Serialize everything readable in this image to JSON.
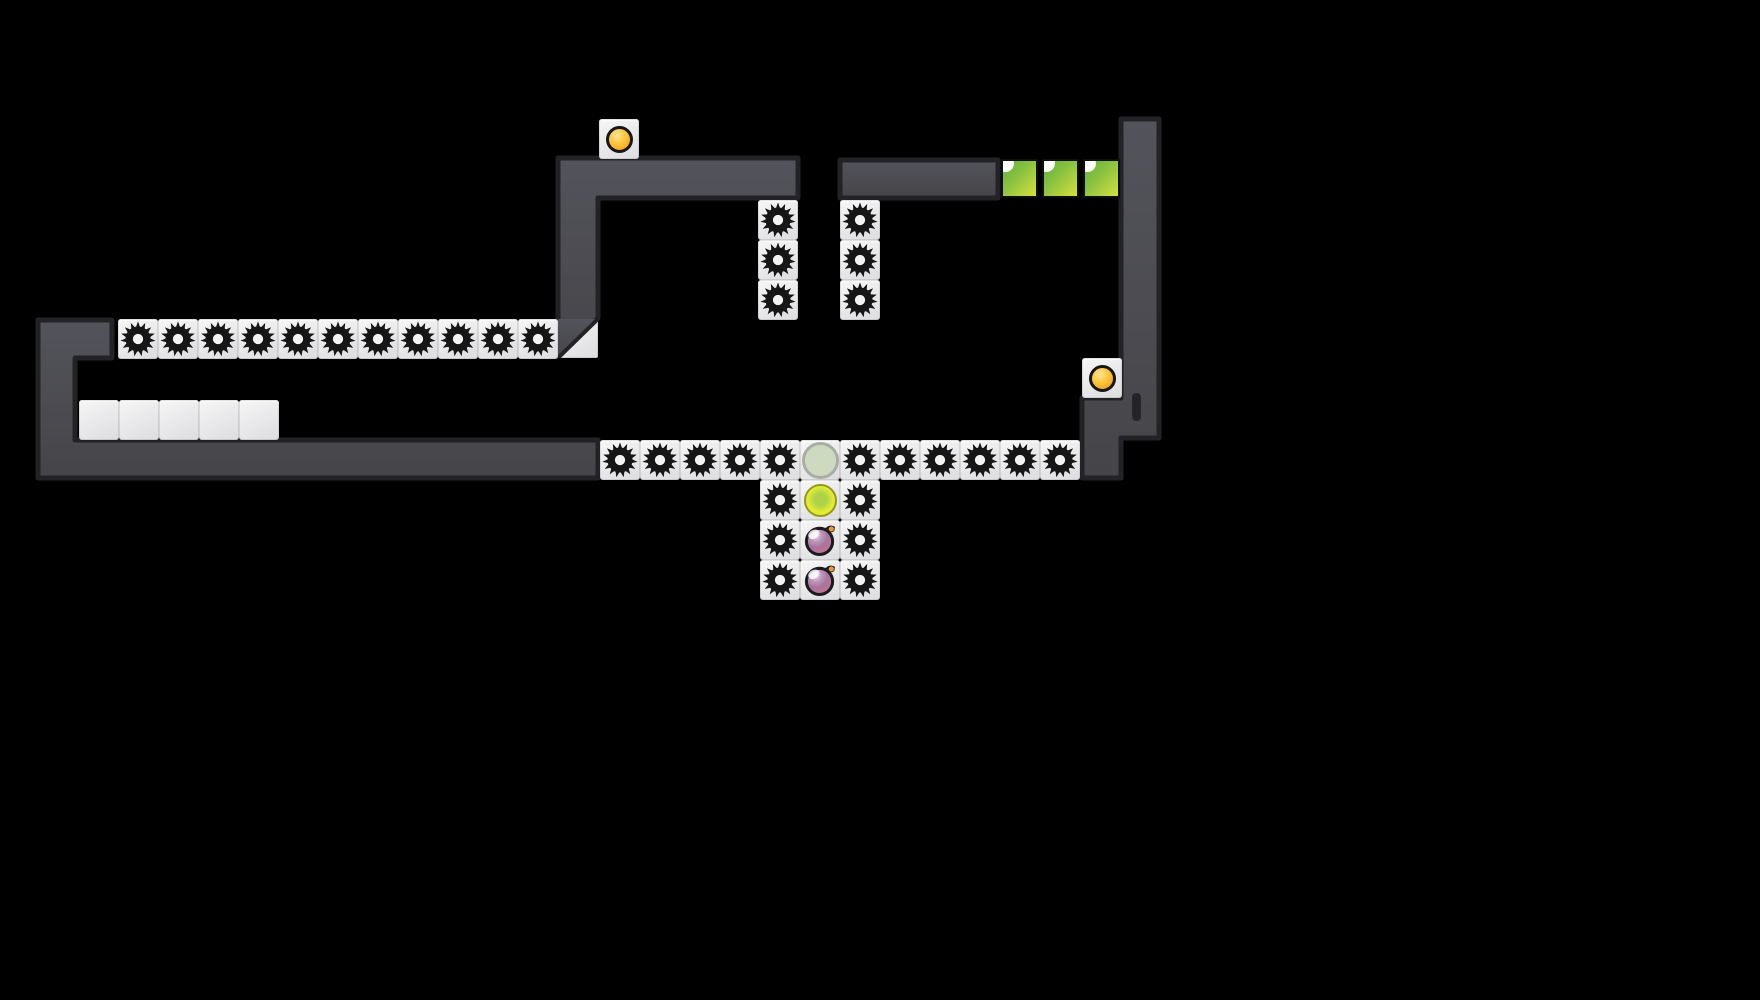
{
  "level": {
    "canvas": {
      "width": 1760,
      "height": 1000
    },
    "palette": {
      "bg": "#000000",
      "wall_fill_top": "#53535b",
      "wall_fill_bottom": "#454549",
      "wall_border": "#232327",
      "tile_fill": "#ececee",
      "saw": "#161616",
      "saw_hole": "#f3f3f3",
      "coin_gold": "#f5a91f",
      "ghost_fill": "#cedabf",
      "ghost_ring": "#a9aea4",
      "lemon_a": "#e9eb33",
      "lemon_b": "#abd44b",
      "lemon_ring": "#8f9a1f",
      "green_a": "#5eb23c",
      "green_b": "#d5e13c",
      "plum_ring": "#1b1b20",
      "plum_stem": "#f09a28"
    },
    "walls": [
      {
        "name": "left-structure-wall",
        "points": [
          [
            38,
            320
          ],
          [
            112,
            320
          ],
          [
            112,
            358
          ],
          [
            75,
            358
          ],
          [
            75,
            440
          ],
          [
            598,
            440
          ],
          [
            598,
            478
          ],
          [
            38,
            478
          ]
        ]
      },
      {
        "name": "upper-left-platform",
        "points": [
          [
            558,
            158
          ],
          [
            798,
            158
          ],
          [
            798,
            198
          ],
          [
            598,
            198
          ],
          [
            598,
            318
          ],
          [
            558,
            356
          ]
        ]
      },
      {
        "name": "upper-right-platform",
        "points": [
          [
            840,
            160
          ],
          [
            998,
            160
          ],
          [
            998,
            198
          ],
          [
            840,
            198
          ]
        ]
      },
      {
        "name": "right-tower-structure",
        "points": [
          [
            1121,
            119
          ],
          [
            1159,
            119
          ],
          [
            1159,
            438
          ],
          [
            1121,
            438
          ],
          [
            1121,
            478
          ],
          [
            1082,
            478
          ],
          [
            1082,
            398
          ],
          [
            1121,
            398
          ]
        ]
      }
    ],
    "wall_slot": {
      "x": 1133,
      "y": 394,
      "w": 7,
      "h": 26
    },
    "tiles": [
      {
        "kind": "coin",
        "x": 599,
        "y": 119
      },
      {
        "kind": "coin",
        "x": 1082,
        "y": 358
      },
      {
        "kind": "green",
        "x": 1001,
        "y": 159
      },
      {
        "kind": "green",
        "x": 1042,
        "y": 159
      },
      {
        "kind": "green",
        "x": 1083,
        "y": 159
      },
      {
        "kind": "saw",
        "x": 758,
        "y": 200
      },
      {
        "kind": "saw",
        "x": 758,
        "y": 240
      },
      {
        "kind": "saw",
        "x": 758,
        "y": 280
      },
      {
        "kind": "saw",
        "x": 840,
        "y": 200
      },
      {
        "kind": "saw",
        "x": 840,
        "y": 240
      },
      {
        "kind": "saw",
        "x": 840,
        "y": 280
      },
      {
        "kind": "saw",
        "x": 118,
        "y": 319
      },
      {
        "kind": "saw",
        "x": 158,
        "y": 319
      },
      {
        "kind": "saw",
        "x": 198,
        "y": 319
      },
      {
        "kind": "saw",
        "x": 238,
        "y": 319
      },
      {
        "kind": "saw",
        "x": 278,
        "y": 319
      },
      {
        "kind": "saw",
        "x": 318,
        "y": 319
      },
      {
        "kind": "saw",
        "x": 358,
        "y": 319
      },
      {
        "kind": "saw",
        "x": 398,
        "y": 319
      },
      {
        "kind": "saw",
        "x": 438,
        "y": 319
      },
      {
        "kind": "saw",
        "x": 478,
        "y": 319
      },
      {
        "kind": "saw",
        "x": 518,
        "y": 319
      },
      {
        "kind": "slope",
        "x": 558,
        "y": 319
      },
      {
        "kind": "blank",
        "x": 79,
        "y": 400
      },
      {
        "kind": "blank",
        "x": 119,
        "y": 400
      },
      {
        "kind": "blank",
        "x": 159,
        "y": 400
      },
      {
        "kind": "blank",
        "x": 199,
        "y": 400
      },
      {
        "kind": "blank",
        "x": 239,
        "y": 400
      },
      {
        "kind": "saw",
        "x": 600,
        "y": 440
      },
      {
        "kind": "saw",
        "x": 640,
        "y": 440
      },
      {
        "kind": "saw",
        "x": 680,
        "y": 440
      },
      {
        "kind": "saw",
        "x": 720,
        "y": 440
      },
      {
        "kind": "saw",
        "x": 760,
        "y": 440
      },
      {
        "kind": "ghost",
        "x": 800,
        "y": 440
      },
      {
        "kind": "saw",
        "x": 840,
        "y": 440
      },
      {
        "kind": "saw",
        "x": 880,
        "y": 440
      },
      {
        "kind": "saw",
        "x": 920,
        "y": 440
      },
      {
        "kind": "saw",
        "x": 960,
        "y": 440
      },
      {
        "kind": "saw",
        "x": 1000,
        "y": 440
      },
      {
        "kind": "saw",
        "x": 1040,
        "y": 440
      },
      {
        "kind": "saw",
        "x": 760,
        "y": 480
      },
      {
        "kind": "lemon",
        "x": 800,
        "y": 480
      },
      {
        "kind": "saw",
        "x": 840,
        "y": 480
      },
      {
        "kind": "saw",
        "x": 760,
        "y": 520
      },
      {
        "kind": "plum",
        "x": 800,
        "y": 520
      },
      {
        "kind": "saw",
        "x": 840,
        "y": 520
      },
      {
        "kind": "saw",
        "x": 760,
        "y": 560
      },
      {
        "kind": "plum",
        "x": 800,
        "y": 560
      },
      {
        "kind": "saw",
        "x": 840,
        "y": 560
      }
    ]
  }
}
